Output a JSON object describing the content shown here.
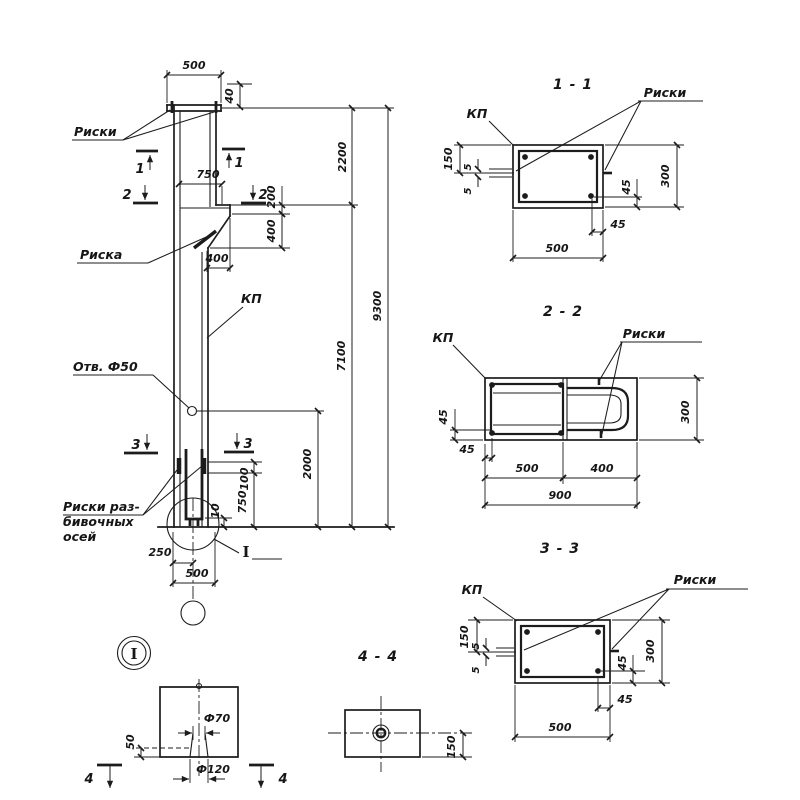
{
  "elevation": {
    "labels": {
      "riski": "Риски",
      "riska": "Риска",
      "kp": "КП",
      "hole": "Отв. Ф50",
      "axes1": "Риски раз-",
      "axes2": "бивочных",
      "axes3": "осей",
      "detail_ref": "I"
    },
    "dims": {
      "w500_top": "500",
      "t40": "40",
      "c750": "750",
      "c200": "200",
      "c400v": "400",
      "c400h": "400",
      "h2200": "2200",
      "h9300": "9300",
      "h7100": "7100",
      "h2000": "2000",
      "b100": "100",
      "b750": "750",
      "b10": "10",
      "b250": "250",
      "b500": "500"
    },
    "marks": {
      "s1": "1",
      "s2": "2",
      "s3": "3"
    }
  },
  "detail_i": {
    "title": "I",
    "dims": {
      "d50": "50",
      "f70": "Ф70",
      "f120": "Ф120"
    },
    "mark": "4"
  },
  "section_1_1": {
    "title": "1 - 1",
    "kp": "КП",
    "riski": "Риски",
    "dims": {
      "left150": "150",
      "g5a": "5",
      "g5b": "5",
      "r45": "45",
      "h300": "300",
      "b45": "45",
      "w500": "500"
    }
  },
  "section_2_2": {
    "title": "2 - 2",
    "kp": "КП",
    "riski": "Риски",
    "dims": {
      "l45": "45",
      "b45": "45",
      "w500": "500",
      "w400": "400",
      "w900": "900",
      "h300": "300"
    }
  },
  "section_3_3": {
    "title": "3 - 3",
    "kp": "КП",
    "riski": "Риски",
    "dims": {
      "left150": "150",
      "g5a": "5",
      "g5b": "5",
      "r45": "45",
      "h300": "300",
      "b45": "45",
      "w500": "500"
    }
  },
  "section_4_4": {
    "title": "4 - 4",
    "dims": {
      "r150": "150"
    }
  },
  "colors": {
    "ink": "#1c1c1c",
    "paper": "#ffffff"
  }
}
